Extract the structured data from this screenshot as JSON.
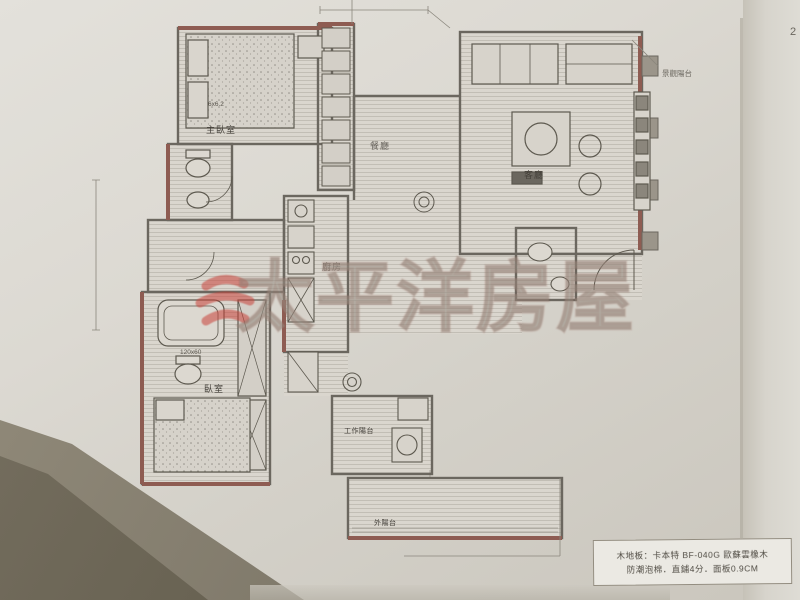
{
  "photo": {
    "watermark": {
      "brand_text": "太平洋房屋"
    },
    "spec_box": {
      "line1": "木地板：卡本特 BF-040G 歐蘇雲橡木",
      "line2": "防潮泡棉．直鋪4分．面板0.9CM"
    },
    "corner_mark": "2"
  },
  "plan": {
    "labels": {
      "master_bedroom": "主臥室",
      "master_bed_dim": "6x6.2",
      "dining": "餐廳",
      "living": "客廳",
      "kitchen": "廚房",
      "bedroom2": "臥室",
      "bath_dim": "120x60",
      "work_balcony": "工作陽台",
      "outer_balcony": "外陽台",
      "view_balcony": "景觀陽台"
    },
    "colors": {
      "wall": "#6b675f",
      "accent_wall": "#8e5c52",
      "watermark_red": "#c9423a"
    }
  }
}
